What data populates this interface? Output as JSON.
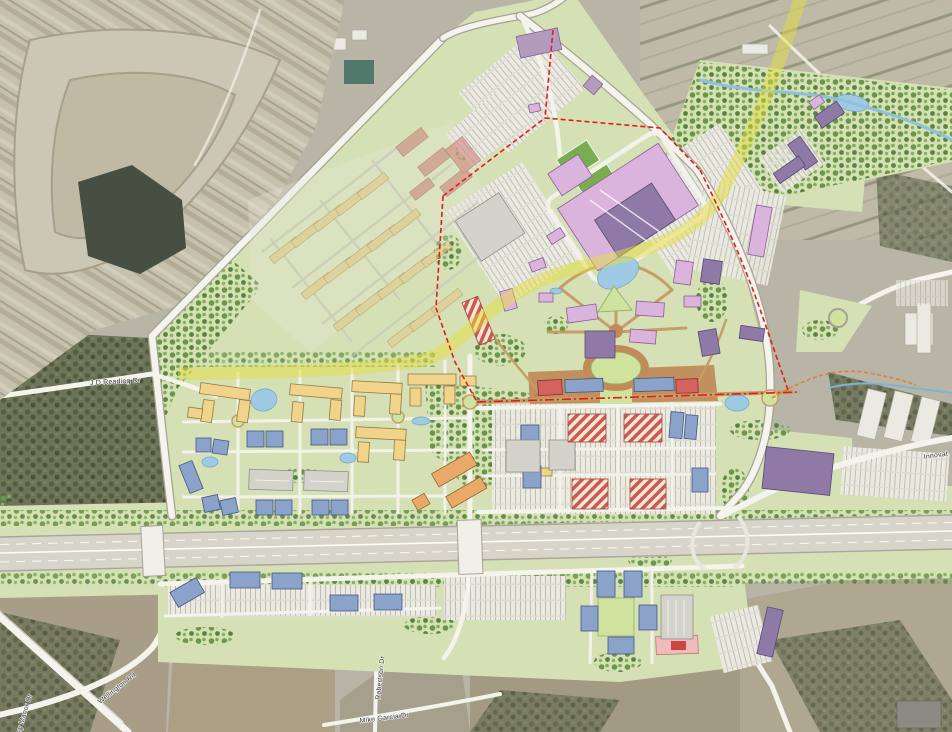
{
  "map": {
    "description": "Aerial photograph with colored master plan overlay: quarry at top-left, planned mixed-use development in center, highway corridor across lower third",
    "street_labels": [
      {
        "id": "jd-reading",
        "text": "J D Reading Dr"
      },
      {
        "id": "wellington",
        "text": "Wellington Rd"
      },
      {
        "id": "sudley-manor",
        "text": "Sudley Manor Dr"
      },
      {
        "id": "robertson",
        "text": "Robertson Dr"
      },
      {
        "id": "mike-garcia",
        "text": "Mike Garcia Dr"
      },
      {
        "id": "innovation",
        "text": "Innovat"
      }
    ],
    "colors": {
      "plan_green": "#d5e1b5",
      "tree_green": "#6d9a4d",
      "residential_yellow": "#f1d489",
      "office_blue": "#8ba2cb",
      "civic_purple": "#8e79a7",
      "retail_lavender": "#dab4dd",
      "mixed_use_red": "#d5635d",
      "hotel_orange": "#e9aa69",
      "stripe_red": "#cc5a52",
      "proposed_road_yellow": "#e3dd3f",
      "boundary_red": "#e31b1b",
      "water_blue": "#9fcae3",
      "aerial_gray": "#b8b4a6",
      "quarry_tan": "#c8c2b0",
      "woods_olive": "#75795f"
    }
  }
}
